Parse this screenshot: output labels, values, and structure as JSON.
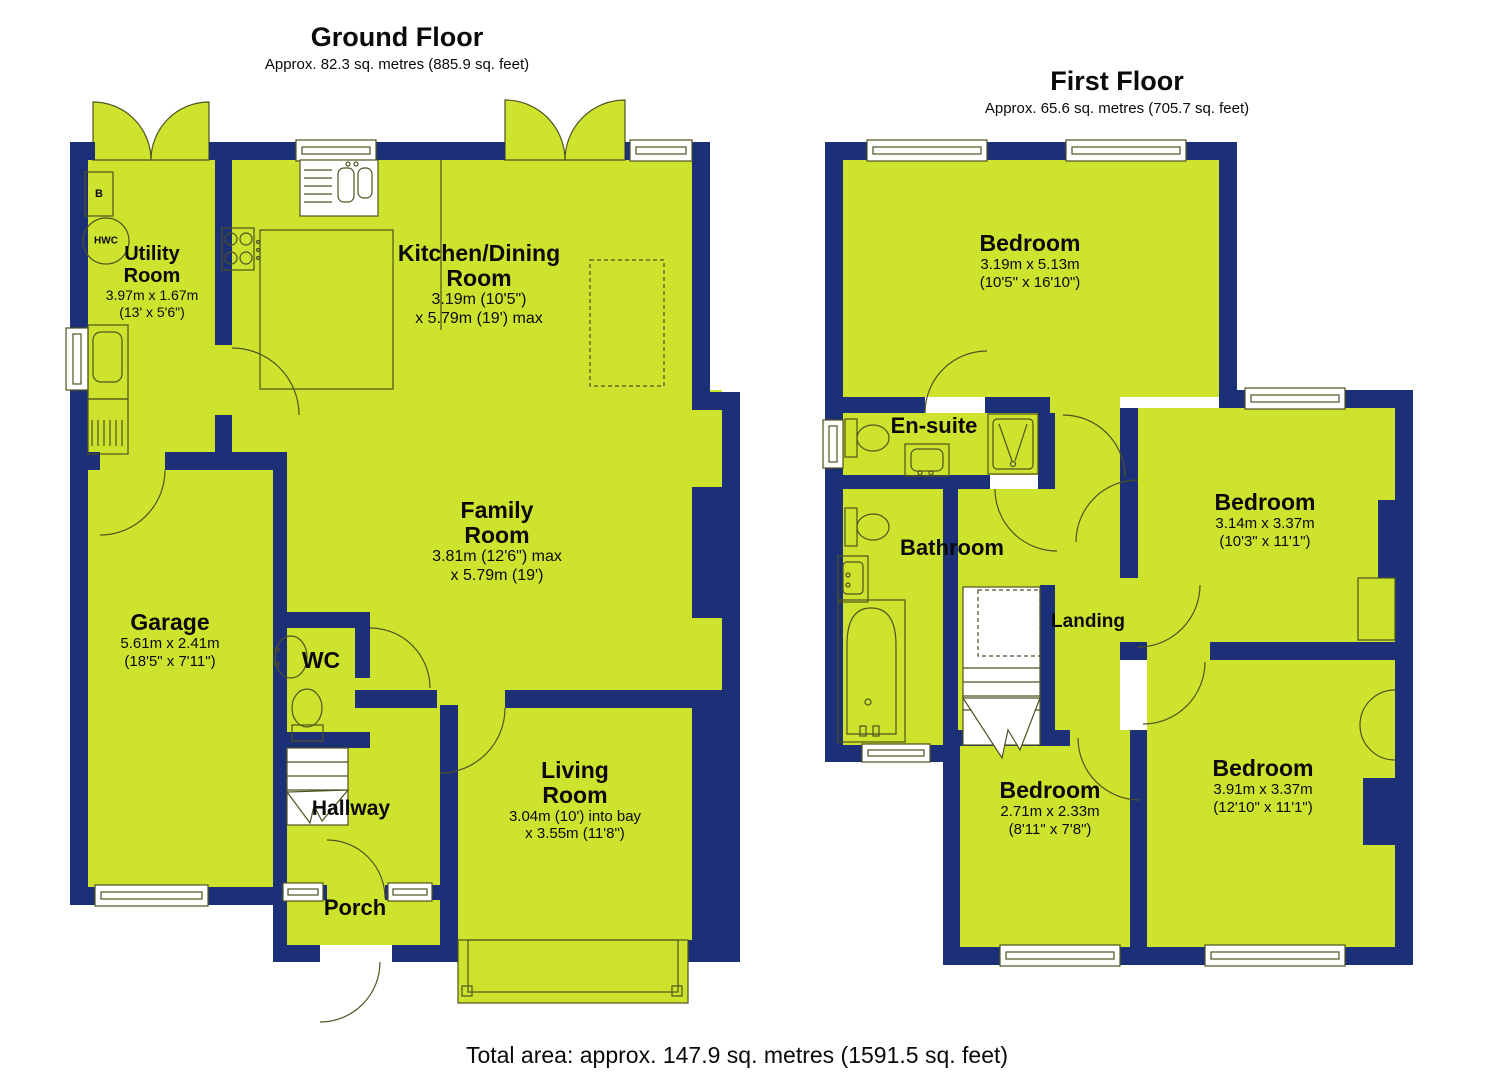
{
  "colors": {
    "room_fill": "#cde32e",
    "wall": "#1b3077",
    "line": "#4f5220"
  },
  "ground_floor": {
    "title": "Ground Floor",
    "subtitle": "Approx. 82.3 sq. metres (885.9 sq. feet)",
    "rooms": {
      "utility": {
        "name": "Utility Room",
        "dims1": "3.97m x 1.67m",
        "dims2": "(13' x 5'6\")"
      },
      "kitchen": {
        "name": "Kitchen/Dining Room",
        "dims1": "3.19m (10'5\")",
        "dims2": "x 5.79m (19') max"
      },
      "family": {
        "name": "Family Room",
        "dims1": "3.81m (12'6\") max",
        "dims2": "x 5.79m (19')"
      },
      "garage": {
        "name": "Garage",
        "dims1": "5.61m x 2.41m",
        "dims2": "(18'5\" x 7'11\")"
      },
      "wc": {
        "name": "WC"
      },
      "hallway": {
        "name": "Hallway"
      },
      "porch": {
        "name": "Porch"
      },
      "living": {
        "name": "Living Room",
        "dims1": "3.04m (10') into bay",
        "dims2": "x 3.55m (11'8\")"
      }
    },
    "annotations": {
      "boiler": "B",
      "hot_water_cylinder": "HWC"
    }
  },
  "first_floor": {
    "title": "First Floor",
    "subtitle": "Approx. 65.6 sq. metres (705.7 sq. feet)",
    "rooms": {
      "bedroom1": {
        "name": "Bedroom",
        "dims1": "3.19m x 5.13m",
        "dims2": "(10'5\" x 16'10\")"
      },
      "ensuite": {
        "name": "En-suite"
      },
      "bathroom": {
        "name": "Bathroom"
      },
      "landing": {
        "name": "Landing"
      },
      "bedroom2": {
        "name": "Bedroom",
        "dims1": "3.14m x 3.37m",
        "dims2": "(10'3\" x 11'1\")"
      },
      "bedroom3": {
        "name": "Bedroom",
        "dims1": "2.71m x 2.33m",
        "dims2": "(8'11\" x 7'8\")"
      },
      "bedroom4": {
        "name": "Bedroom",
        "dims1": "3.91m x 3.37m",
        "dims2": "(12'10\" x 11'1\")"
      }
    }
  },
  "footer": {
    "total_area": "Total area: approx. 147.9 sq. metres (1591.5 sq. feet)"
  }
}
